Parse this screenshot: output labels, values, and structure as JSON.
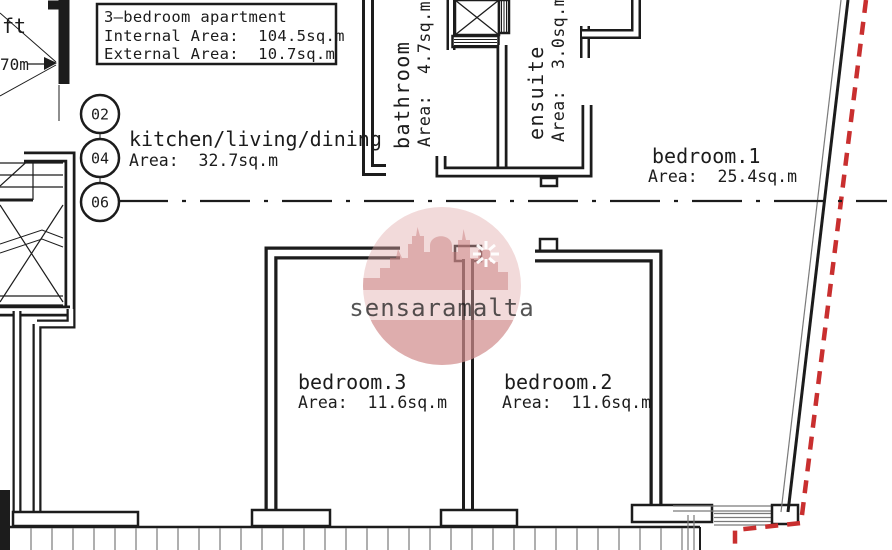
{
  "plan": {
    "title_box": {
      "line1": "3—bedroom apartment",
      "line2": "Internal Area:  104.5sq.m",
      "line3": "External Area:  10.7sq.m"
    },
    "rooms": {
      "kitchen": {
        "name": "kitchen/living/dining",
        "area": "Area:  32.7sq.m"
      },
      "bathroom": {
        "name": "bathroom",
        "area": "Area:  4.7sq.m"
      },
      "ensuite": {
        "name": "ensuite",
        "area": "Area:  3.0sq.m"
      },
      "bedroom1": {
        "name": "bedroom.1",
        "area": "Area:  25.4sq.m"
      },
      "bedroom2": {
        "name": "bedroom.2",
        "area": "Area:  11.6sq.m"
      },
      "bedroom3": {
        "name": "bedroom.3",
        "area": "Area:  11.6sq.m"
      }
    },
    "markers": {
      "m1": "02",
      "m2": "04",
      "m3": "06"
    },
    "dimension": {
      "partial_label": "ft",
      "value": "70m"
    },
    "watermark": {
      "text": "sensaramalta"
    },
    "colors": {
      "wall": "#1c1c1c",
      "boundary_red": "#c92f2f",
      "watermark_pink": "#dfa8a8"
    }
  }
}
